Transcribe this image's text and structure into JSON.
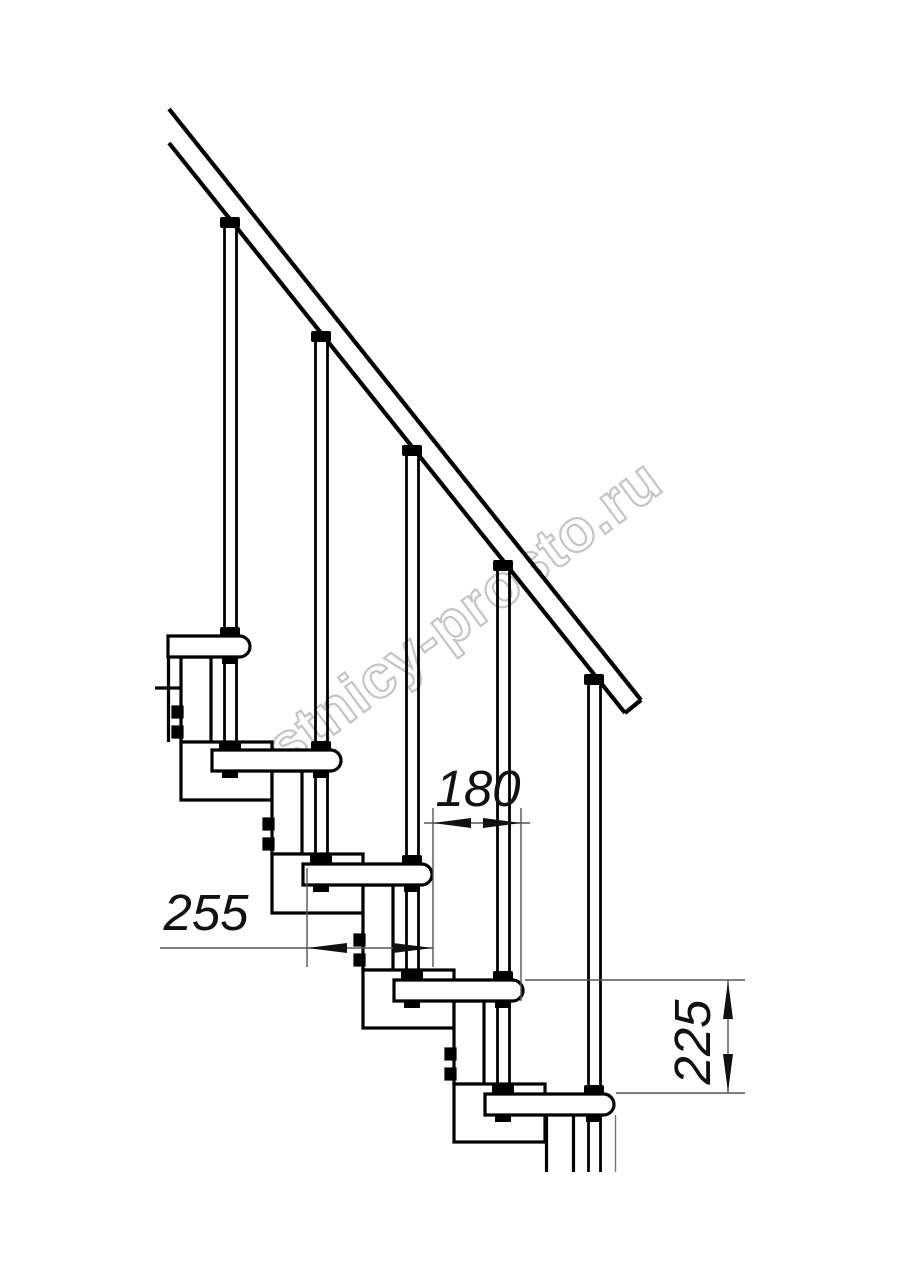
{
  "drawing": {
    "kind": "staircase-side-elevation",
    "background": "#ffffff",
    "line_color": "#000000",
    "thin_line_color": "#555555",
    "treads_count": 5,
    "balusters_count": 5,
    "has_handrail": true
  },
  "watermark": {
    "text": "lestnicy-prosto.ru",
    "color": "#c5c5c5"
  },
  "dimensions": {
    "going": {
      "label": "180"
    },
    "depth": {
      "label": "255"
    },
    "rise": {
      "label": "225"
    }
  }
}
